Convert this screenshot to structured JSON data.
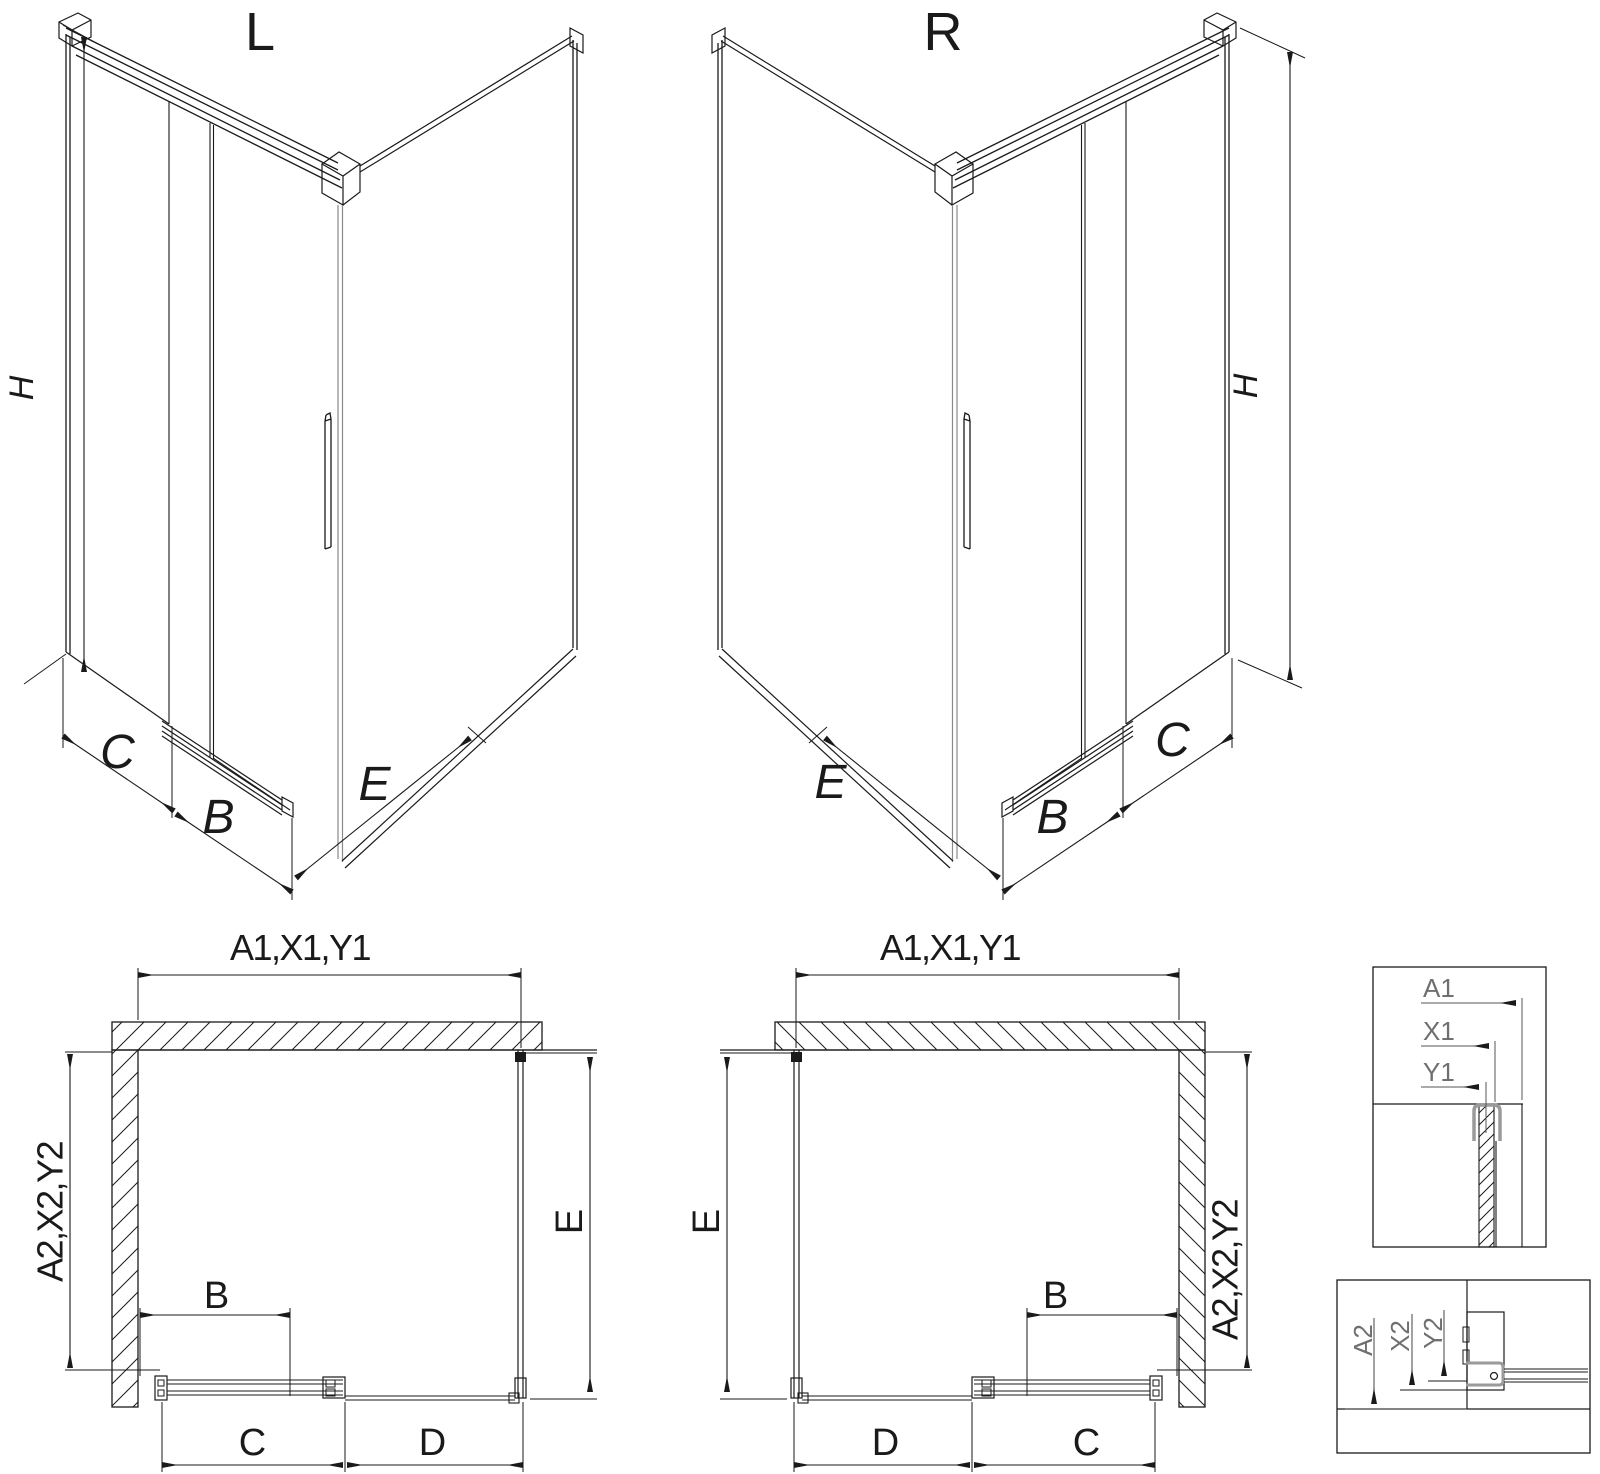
{
  "diagram_title": "shower enclosure corner entry technical drawing",
  "colors": {
    "line": "#1a1a1a",
    "gray_profile": "#9a9a9a",
    "detail_label": "#6f6f6f",
    "background": "#ffffff"
  },
  "iso_left": {
    "title": "L",
    "dim_height": "H",
    "dim_back_panel": "C",
    "dim_door": "B",
    "dim_side_panel": "E"
  },
  "iso_right": {
    "title": "R",
    "dim_height": "H",
    "dim_back_panel": "C",
    "dim_door": "B",
    "dim_side_panel": "E"
  },
  "plan_left": {
    "dim_top": "A1,X1,Y1",
    "dim_left": "A2,X2,Y2",
    "dim_right": "E",
    "dim_door": "B",
    "dim_bottom_inner": "C",
    "dim_bottom_outer": "D"
  },
  "plan_right": {
    "dim_top": "A1,X1,Y1",
    "dim_right": "A2,X2,Y2",
    "dim_left": "E",
    "dim_door": "B",
    "dim_bottom_inner": "C",
    "dim_bottom_outer": "D"
  },
  "detail_top": {
    "dim_1": "A1",
    "dim_2": "X1",
    "dim_3": "Y1"
  },
  "detail_bottom": {
    "dim_1": "A2",
    "dim_2": "X2",
    "dim_3": "Y2"
  }
}
